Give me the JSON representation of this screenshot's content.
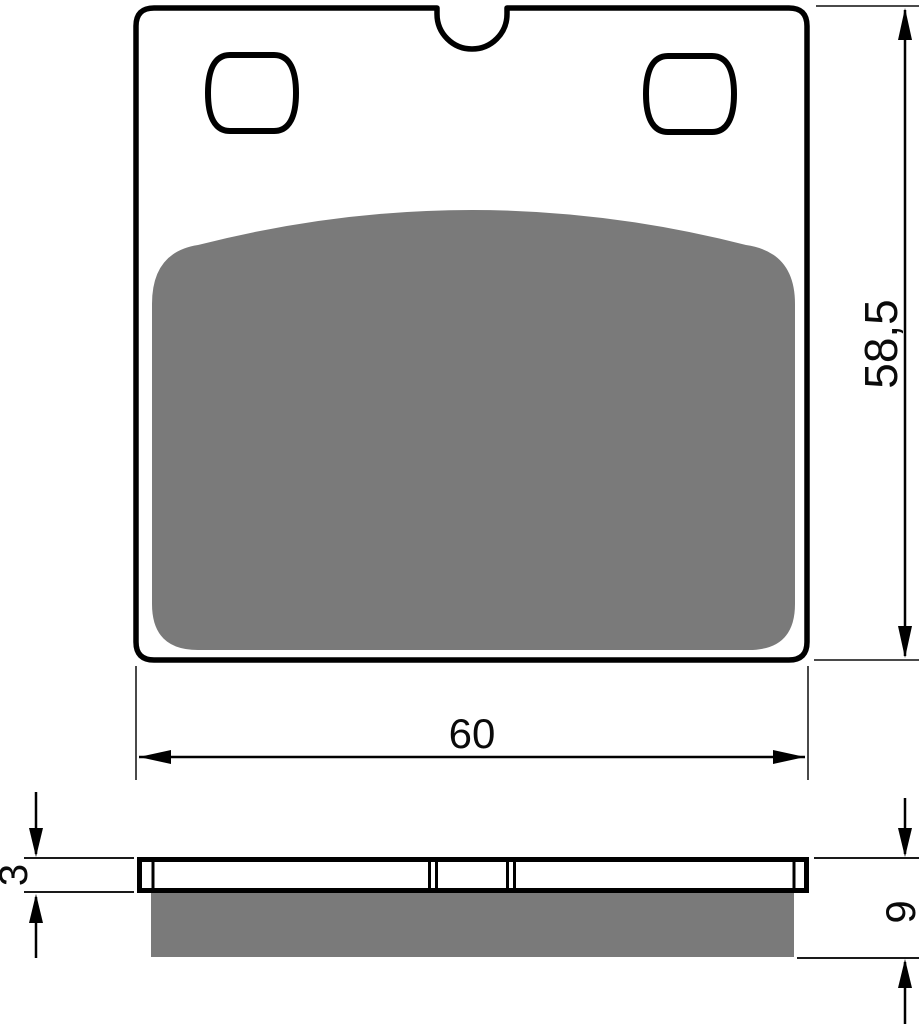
{
  "drawing": {
    "title": "Brake pad dimensional drawing, front and side views",
    "front_view": {
      "width_dim_label": "60",
      "height_dim_label": "58,5"
    },
    "side_view": {
      "backplate_thickness_dim_label": "3",
      "total_thickness_dim_label": "9"
    },
    "colors": {
      "friction_material": "#7a7a7a",
      "outline": "#000000",
      "dimension_line": "#000000",
      "extension_line": "#4a4a4a",
      "background": "#ffffff"
    }
  }
}
